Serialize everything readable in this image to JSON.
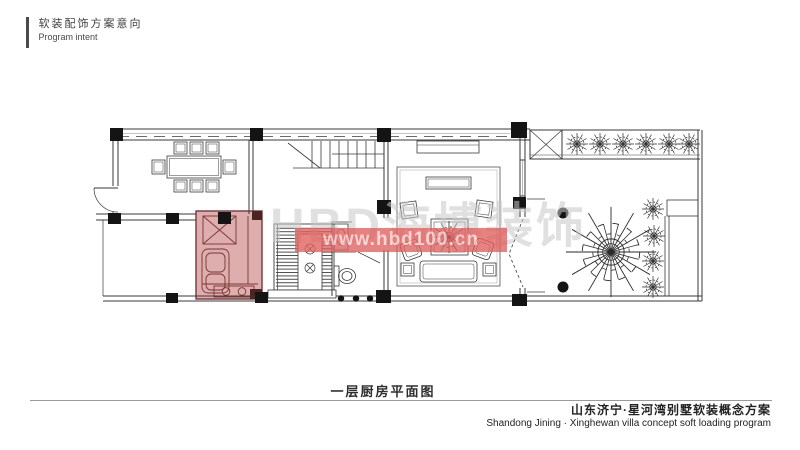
{
  "header": {
    "title_cn": "软装配饰方案意向",
    "title_en": "Program intent"
  },
  "watermark": {
    "brand": "HBD海博装饰",
    "url": "www.hbd100.cn"
  },
  "caption": {
    "title": "一层厨房平面图"
  },
  "footer": {
    "project_cn": "山东济宁·星河湾别墅软装概念方案",
    "project_en": "Shandong Jining · Xinghewan villa concept soft loading program"
  },
  "colors": {
    "kitchen_fill": "#d9a2a2",
    "kitchen_stroke": "#7a3636",
    "kitchen_dark": "#4a2323",
    "watermark_band": "#e25f5d",
    "watermark_text": "#ffd9d9",
    "watermark_gray": "#c8c8c8",
    "line": "#3a3a3a"
  }
}
